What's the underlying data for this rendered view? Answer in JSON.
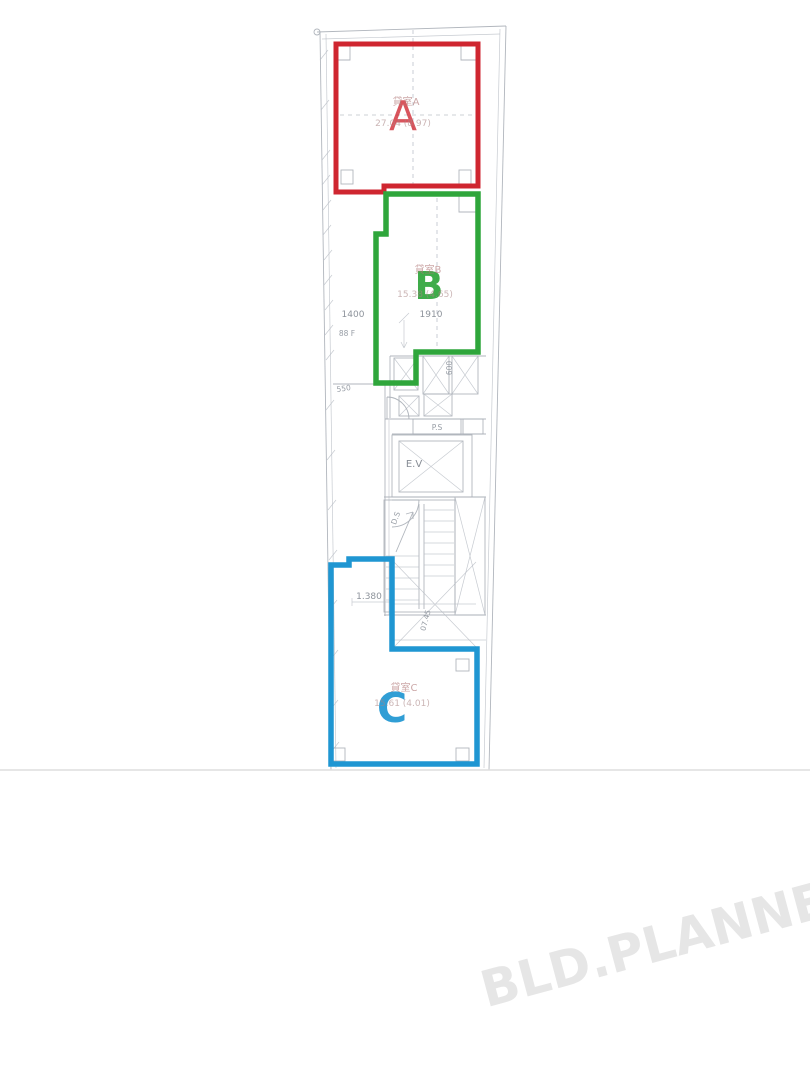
{
  "page": {
    "background": "#ffffff"
  },
  "watermark": {
    "text": "BLD.PLANNER",
    "color": "#e6e6e6"
  },
  "plan": {
    "line_color": "#a9aeb6",
    "zones": [
      {
        "id": "a",
        "letter": "A",
        "name_label": "貸室A",
        "area_label": "27.04 (8.97)",
        "color": "#cf2630"
      },
      {
        "id": "b",
        "letter": "B",
        "name_label": "貸室B",
        "area_label": "15.38 (4.65)",
        "color": "#2fa63b"
      },
      {
        "id": "c",
        "letter": "C",
        "name_label": "貸室C",
        "area_label": "15.61 (4.01)",
        "color": "#1f96d2"
      }
    ],
    "labels": {
      "elevator": "E.V",
      "pipe_shaft": "P.S",
      "duct_shaft": "D.S",
      "stair_note": "07.45",
      "floor_note": "88 F",
      "dim_1400": "1400",
      "dim_1910": "1910",
      "dim_550": "550",
      "dim_600": "600",
      "dim_1380": "1.380"
    }
  }
}
